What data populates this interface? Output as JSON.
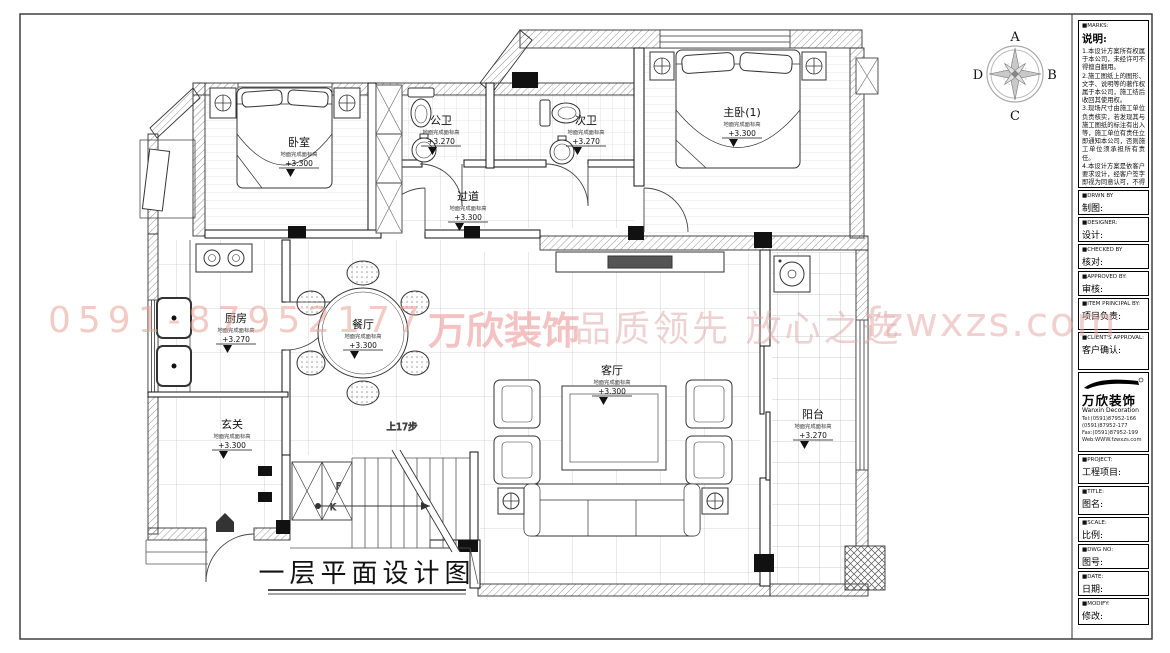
{
  "drawing_title": "一层平面设计图",
  "compass": {
    "top": "A",
    "right": "B",
    "bottom": "C",
    "left": "D"
  },
  "watermark": {
    "phone": "0591-87952177",
    "brand": "万欣装饰",
    "slogan": "品质领先 放心之选",
    "site": "fzwxzs.com"
  },
  "stairs_area": {
    "direction_label": "上17步",
    "cabinet_letter_1": "F",
    "cabinet_letter_2": "K"
  },
  "rooms": {
    "bedroom": {
      "name": "卧室",
      "note": "地面完成面标高",
      "elevation": "+3.300"
    },
    "public_bath": {
      "name": "公卫",
      "note": "地面完成面标高",
      "elevation": "+3.270"
    },
    "second_bath": {
      "name": "次卫",
      "note": "地面完成面标高",
      "elevation": "+3.270"
    },
    "master_bedroom": {
      "name": "主卧(1)",
      "note": "地面完成面标高",
      "elevation": "+3.300"
    },
    "hallway": {
      "name": "过道",
      "note": "地面完成面标高",
      "elevation": "+3.300"
    },
    "kitchen": {
      "name": "厨房",
      "note": "地面完成面标高",
      "elevation": "+3.270"
    },
    "entry": {
      "name": "玄关",
      "note": "地面完成面标高",
      "elevation": "+3.300"
    },
    "dining": {
      "name": "餐厅",
      "note": "地面完成面标高",
      "elevation": "+3.300"
    },
    "living": {
      "name": "客厅",
      "note": "地面完成面标高",
      "elevation": "+3.300"
    },
    "balcony": {
      "name": "阳台",
      "note": "地面完成面标高",
      "elevation": "+3.270"
    }
  },
  "titleblock": {
    "marks": {
      "header": "■MARKS:",
      "title": "说明:",
      "notes": "1.本设计方案所有权属于本公司，未经许可不得擅自翻用。\n2.施工图纸上的图形、文字、说明等的著作权属于本公司，施工结后收回其使用权。\n3.现场尺寸由施工单位负责核实，若发现其与施工图纸的标注有出入等，施工单位有责任立即通知本公司，否则施工单位须承担所有责任。\n4.本设计方案是依客户要求设计，经客户签字即视为同意认可，不得随意更改。"
    },
    "fields": [
      {
        "en": "■DRWN BY",
        "zh": "制图:"
      },
      {
        "en": "■DESIGNER:",
        "zh": "设计:"
      },
      {
        "en": "■CHECKED BY",
        "zh": "核对:"
      },
      {
        "en": "■APPROVED BY:",
        "zh": "审核:"
      },
      {
        "en": "■ITEM PRINCIPAL BY:",
        "zh": "项目负责:"
      },
      {
        "en": "■CLIENT'S APPROVAL:",
        "zh": "客户确认:"
      }
    ],
    "company": {
      "name": "万欣装饰",
      "name_en": "Wanxin Decoration",
      "tel1": "Tel:(0591)87952-166",
      "tel2": "(0591)87952-177",
      "fax": "Fax:(0591)87952-199",
      "web": "Web:WWW.fzwxzs.com"
    },
    "fields2": [
      {
        "en": "■PROJECT:",
        "zh": "工程项目:"
      },
      {
        "en": "■TITLE:",
        "zh": "图名:"
      },
      {
        "en": "■SCALE:",
        "zh": "比例:"
      },
      {
        "en": "■DWG NO:",
        "zh": "图号:"
      },
      {
        "en": "■DATE:",
        "zh": "日期:"
      },
      {
        "en": "■MODIFY:",
        "zh": "修改:"
      }
    ]
  }
}
